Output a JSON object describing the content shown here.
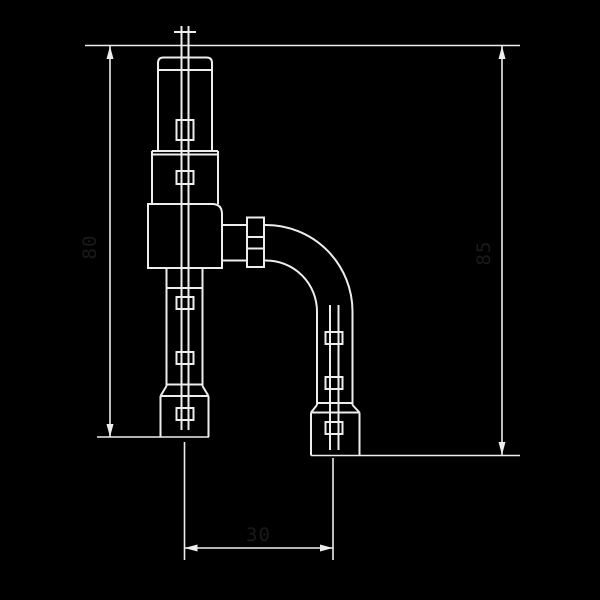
{
  "drawing": {
    "colors": {
      "background": "#000000",
      "line": "#ededed",
      "dim_text": "#1a1a1a"
    },
    "labels": {
      "left_height": "80",
      "right_height": "85",
      "bottom_width": "30"
    }
  }
}
